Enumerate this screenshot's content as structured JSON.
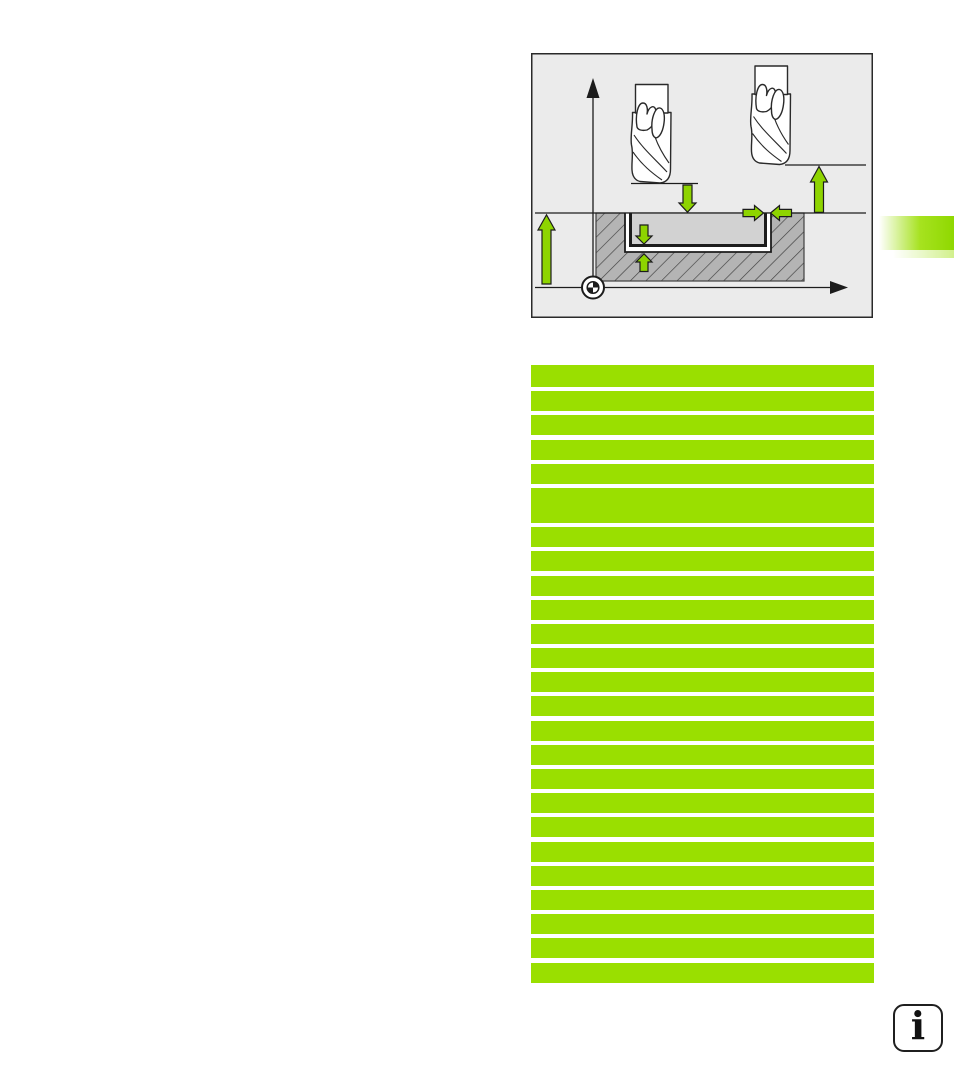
{
  "colors": {
    "accent_green": "#9adf00",
    "arrow_green": "#8ed400",
    "tab_green": "#8fd800",
    "diagram_bg": "#ebebeb",
    "workpiece_gray": "#b4b4b4",
    "pocket_gray": "#d2d2d2",
    "outline": "#1c1c1c"
  },
  "program_listing": {
    "rows": [
      {
        "h": 22
      },
      {
        "h": 20
      },
      {
        "h": 20
      },
      {
        "h": 20
      },
      {
        "h": 20
      },
      {
        "h": 35
      },
      {
        "h": 20
      },
      {
        "h": 20
      },
      {
        "h": 20
      },
      {
        "h": 20
      },
      {
        "h": 20
      },
      {
        "h": 20
      },
      {
        "h": 20
      },
      {
        "h": 20
      },
      {
        "h": 20
      },
      {
        "h": 20
      },
      {
        "h": 20
      },
      {
        "h": 20
      },
      {
        "h": 20
      },
      {
        "h": 20
      },
      {
        "h": 20
      },
      {
        "h": 20
      },
      {
        "h": 20
      },
      {
        "h": 20
      },
      {
        "h": 20
      }
    ]
  },
  "info_icon": {
    "glyph": "i"
  }
}
